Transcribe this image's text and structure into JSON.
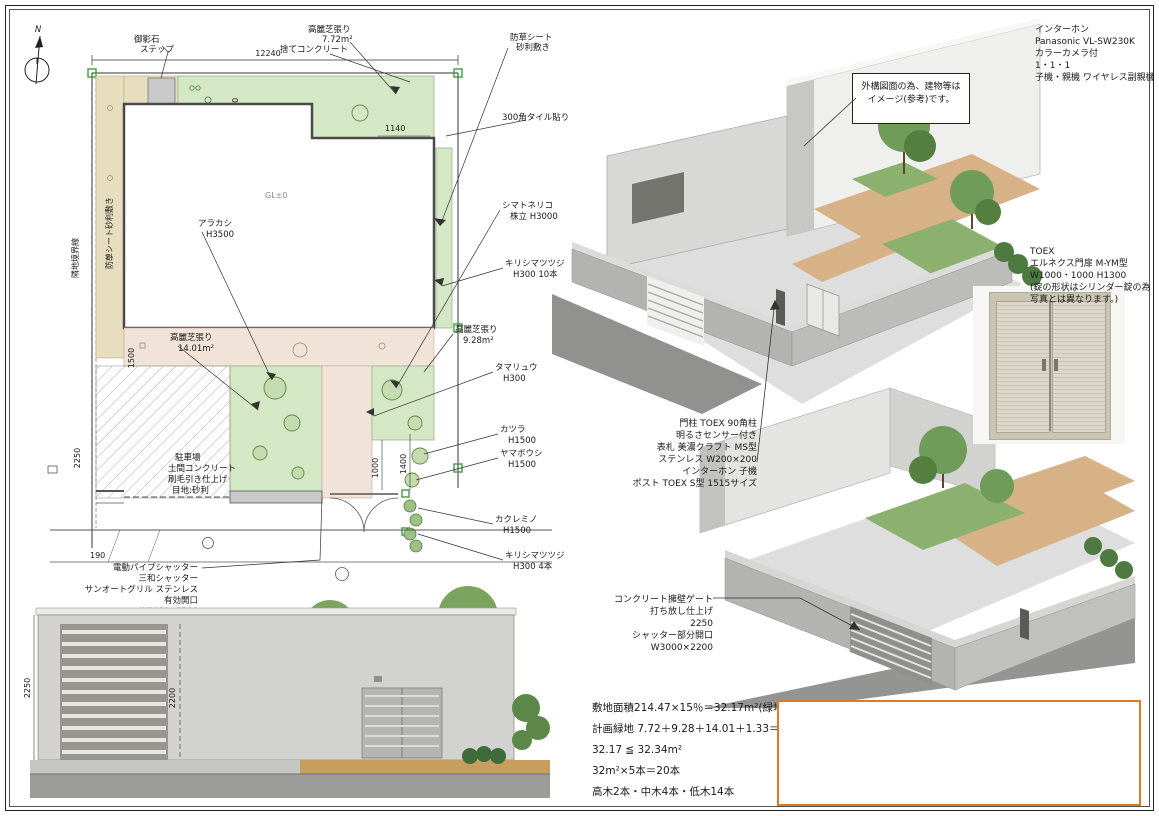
{
  "compass": {
    "label": "N"
  },
  "intercom_spec": {
    "lines": [
      "インターホン",
      "Panasonic VL-SW230K",
      "カラーカメラ付",
      "1・1・1",
      "子機・親機 ワイヤレス副親機"
    ]
  },
  "note_box": {
    "lines": [
      "外構図面の為、建物等は",
      "イメージ(参考)です。"
    ]
  },
  "toex_spec": {
    "lines": [
      "TOEX",
      "エルネクス門扉 M-YM型",
      "W1000・1000 H1300",
      "(錠の形状はシリンダー錠の為",
      "写真とは異なります。)"
    ]
  },
  "gatepost_spec": {
    "lines": [
      "門柱 TOEX 90角柱",
      "明るさセンサー付き",
      "表札 美濃クラフト MS型",
      "ステンレス W200×200",
      "インターホン 子機",
      "ポスト TOEX S型 1515サイズ"
    ]
  },
  "gate2_label": {
    "lines": [
      "コンクリート擁壁ゲート",
      "打ち放し仕上げ",
      "2250",
      "シャッター部分開口",
      "W3000×2200"
    ]
  },
  "shutter_label": {
    "lines": [
      "電動パイプシャッター",
      "三和シャッター",
      "サンオートグリル ステンレス",
      "有効開口",
      "W3000×2200"
    ]
  },
  "parking_label": {
    "lines": [
      "駐車場",
      "土間コンクリート",
      "刷毛引き仕上げ",
      "目地:砂利"
    ]
  },
  "calc": {
    "lines": [
      "敷地面積214.47×15％＝32.17m²(緑地面積)",
      "計画緑地 7.72＋9.28＋14.01＋1.33＝32.34m²",
      "32.17 ≦ 32.34m²",
      "32m²×5本＝20本",
      "高木2本・中木4本・低木14本"
    ]
  },
  "plan": {
    "labels": {
      "step": [
        "御影石",
        "ステップ"
      ],
      "stamp_concrete": [
        "捨てコンクリート"
      ],
      "lawn_top": [
        "高麗芝張り",
        "7.72m²"
      ],
      "gravel": [
        "防草シート",
        "砂利敷き"
      ],
      "gravel_v": "防草シート砂利敷き",
      "tile300": [
        "300角タイル貼り"
      ],
      "shimatoneriko": [
        "シマトネリコ",
        "株立 H3000"
      ],
      "kirishima10": [
        "キリシマツツジ",
        "H300 10本"
      ],
      "lawn_side": [
        "高麗芝張り",
        "9.28m²"
      ],
      "tamaryu": [
        "タマリュウ",
        "H300"
      ],
      "katsura": [
        "カツラ",
        "H1500"
      ],
      "yamaboushi": [
        "ヤマボウシ",
        "H1500"
      ],
      "kakuremino": [
        "カクレミノ",
        "H1500"
      ],
      "kirishima4": [
        "キリシマツツジ",
        "H300 4本"
      ],
      "arakashi": [
        "アラカシ",
        "H3500"
      ],
      "lawn_mid": [
        "高麗芝張り",
        "14.01m²"
      ],
      "boundary_left": "隣地境界線",
      "gl": "GL±0"
    },
    "dims": {
      "total_w": "12240",
      "d1150": "1150",
      "d1000a": "1000",
      "d1140": "1140",
      "d1500": "1500",
      "d1000b": "1000",
      "d1400": "1400",
      "d190": "190",
      "d2250": "2250"
    }
  },
  "elevation": {
    "dims": {
      "v2200": "2200",
      "v2250": "2250"
    }
  },
  "colors": {
    "accent_orange": "#dd7b22",
    "lawn_green": "#d5e8c6",
    "strip_tan": "#e7debf",
    "paving_pink": "#f1e3d7",
    "tree_green": "#5d8748",
    "wood_deck": "#d7b286",
    "concrete_gray": "#c9c9c7"
  }
}
